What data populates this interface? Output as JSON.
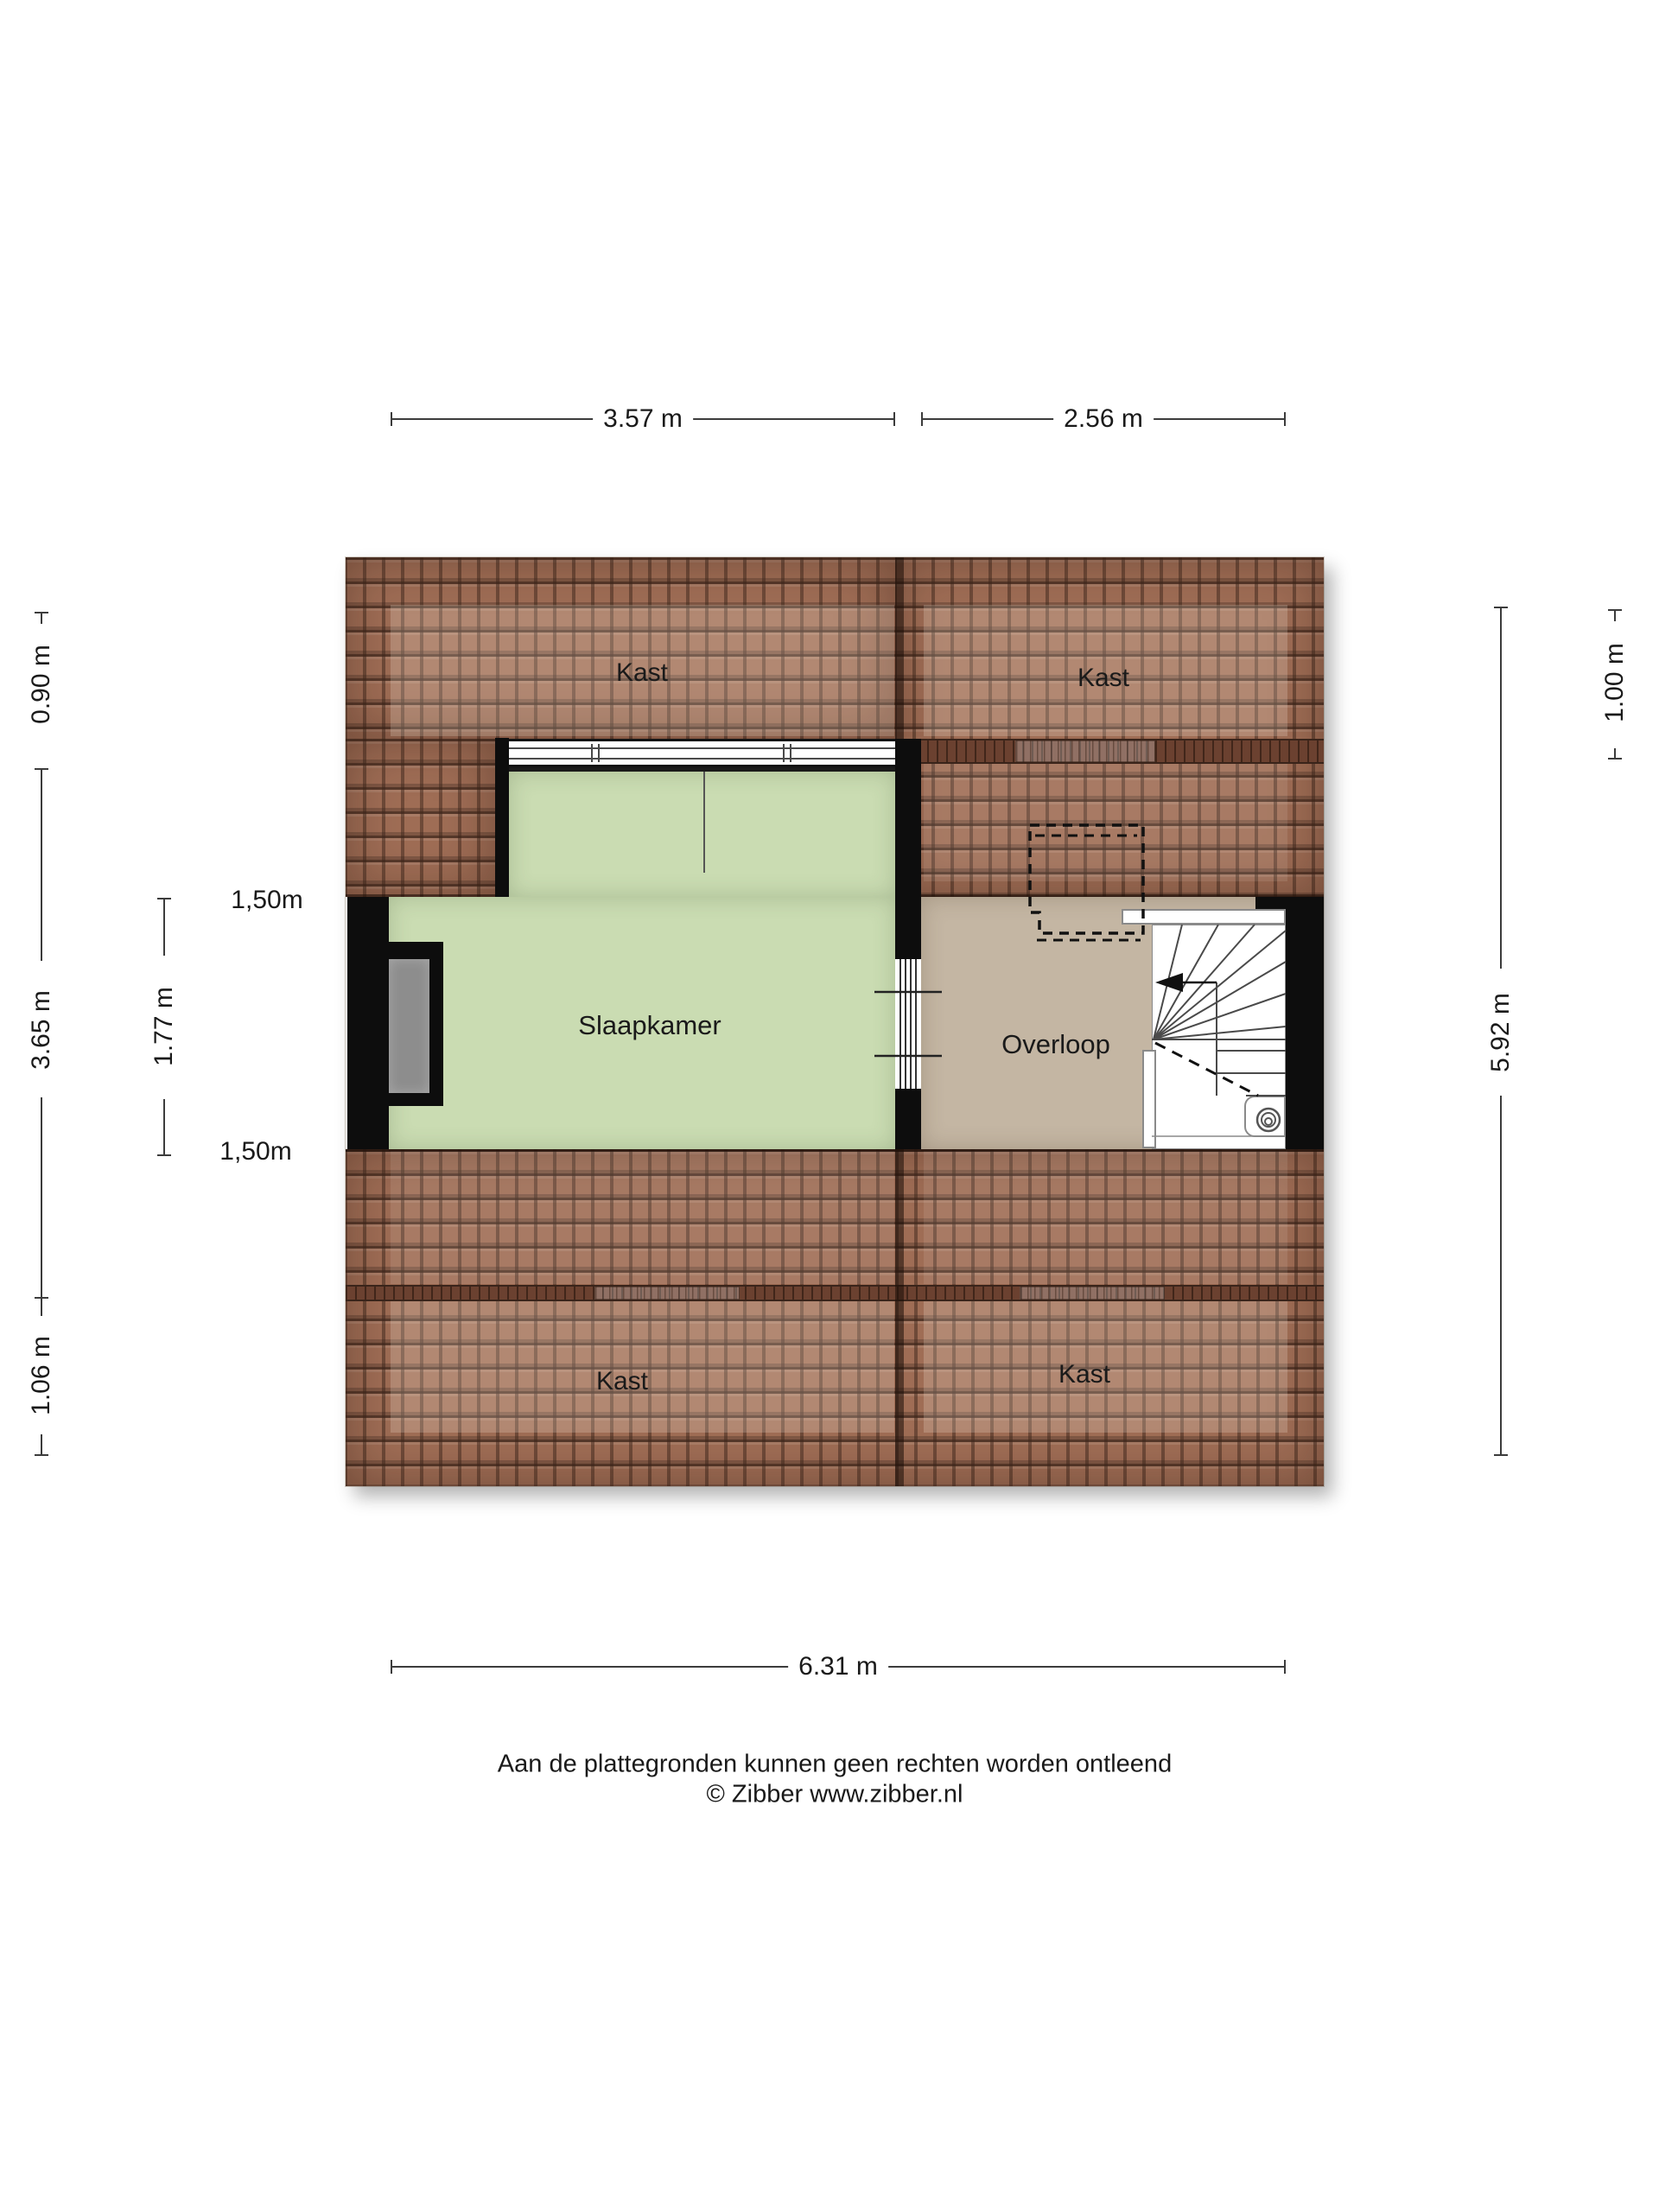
{
  "title": "Floor plan - attic (zolder)",
  "rooms": {
    "bedroom": "Slaapkamer",
    "landing": "Overloop",
    "closets": [
      "Kast",
      "Kast",
      "Kast",
      "Kast"
    ]
  },
  "dims": {
    "top": [
      "3.57 m",
      "2.56 m"
    ],
    "bottom": [
      "6.31 m"
    ],
    "left": [
      "0.90 m",
      "3.65 m",
      "1.06 m"
    ],
    "right": [
      "5.92 m",
      "1.00 m"
    ],
    "inner_left": [
      "1,50m",
      "1.77 m",
      "1,50m"
    ]
  },
  "footer": {
    "line1": "Aan de plattegronden kunnen geen rechten worden ontleend",
    "line2": "© Zibber www.zibber.nl"
  },
  "colors": {
    "roof_base": "#9f6d55",
    "band": "#6b4130",
    "bedroom_floor": "#cadcb2",
    "landing_floor": "#c4b6a3",
    "wall": "#0d0d0d",
    "chimney": "#8d8d8d",
    "dim_line": "#3c3c3c",
    "text": "#1a1a1a"
  }
}
